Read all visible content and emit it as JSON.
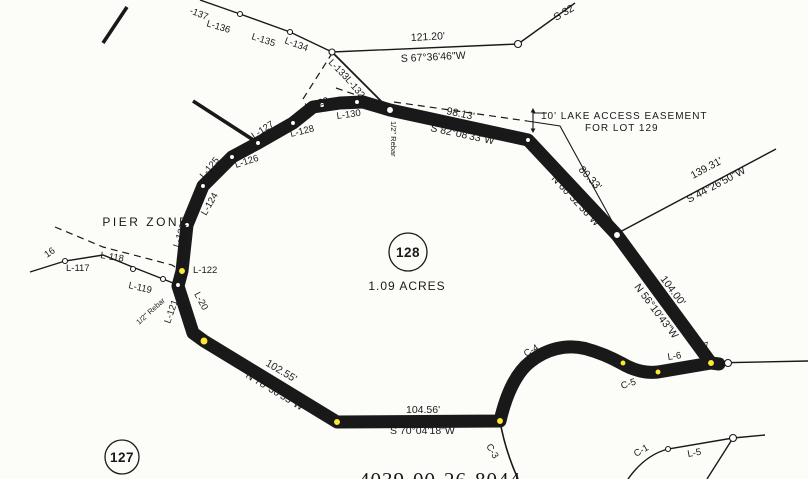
{
  "map": {
    "parcel_number": "4039-00-26-8044",
    "lot": {
      "number": "128",
      "area": "1.09 ACRES"
    },
    "adjacent_lot": {
      "number": "127"
    },
    "zone_label": "PIER ZONE",
    "easement_note": {
      "line1": "10' LAKE ACCESS EASEMENT",
      "line2": "FOR LOT 129"
    },
    "monuments": {
      "rebar_top": "1/2\" Rebar",
      "rebar_left": "1/2\" Rebar"
    },
    "partial_bearing_top_right": "S 32",
    "colors": {
      "highlight": "#ffe833",
      "line": "#191919",
      "paper": "#fcfcf9"
    }
  },
  "courses": [
    {
      "distance": "121.20'",
      "bearing": "S 67°36'46\"W"
    },
    {
      "distance": "98.13'",
      "bearing": "S 82°08'33\"W"
    },
    {
      "distance": "80.33'",
      "bearing": "N 60°32'36\"W"
    },
    {
      "distance": "139.31'",
      "bearing": "S 44°26'50\"W"
    },
    {
      "distance": "104.00'",
      "bearing": "N 56°10'43\"W"
    },
    {
      "distance": "104.56'",
      "bearing": "S 70°04'18\"W"
    },
    {
      "distance": "102.55'",
      "bearing": "N 78°30'55\"W"
    }
  ],
  "segments": {
    "l137": "-137",
    "l136": "L-136",
    "l135": "L-135",
    "l134": "L-134",
    "l133": "L-133",
    "l132": "L-132",
    "l130": "L-130",
    "l129": "L-129",
    "l128": "L-128",
    "l127": "L-127",
    "l126": "L-126",
    "l125": "L-125",
    "l124": "L-124",
    "l123": "L-123",
    "l122": "L-122",
    "l121": "L-121",
    "l120": "L-20",
    "l119": "L-119",
    "l118": "L-118",
    "l117": "L-117",
    "l116": "16",
    "l7": "L-7",
    "l6": "L-6",
    "l5": "L-5",
    "c1": "C-1",
    "c3": "C-3",
    "c4": "C-4",
    "c5": "C-5"
  }
}
